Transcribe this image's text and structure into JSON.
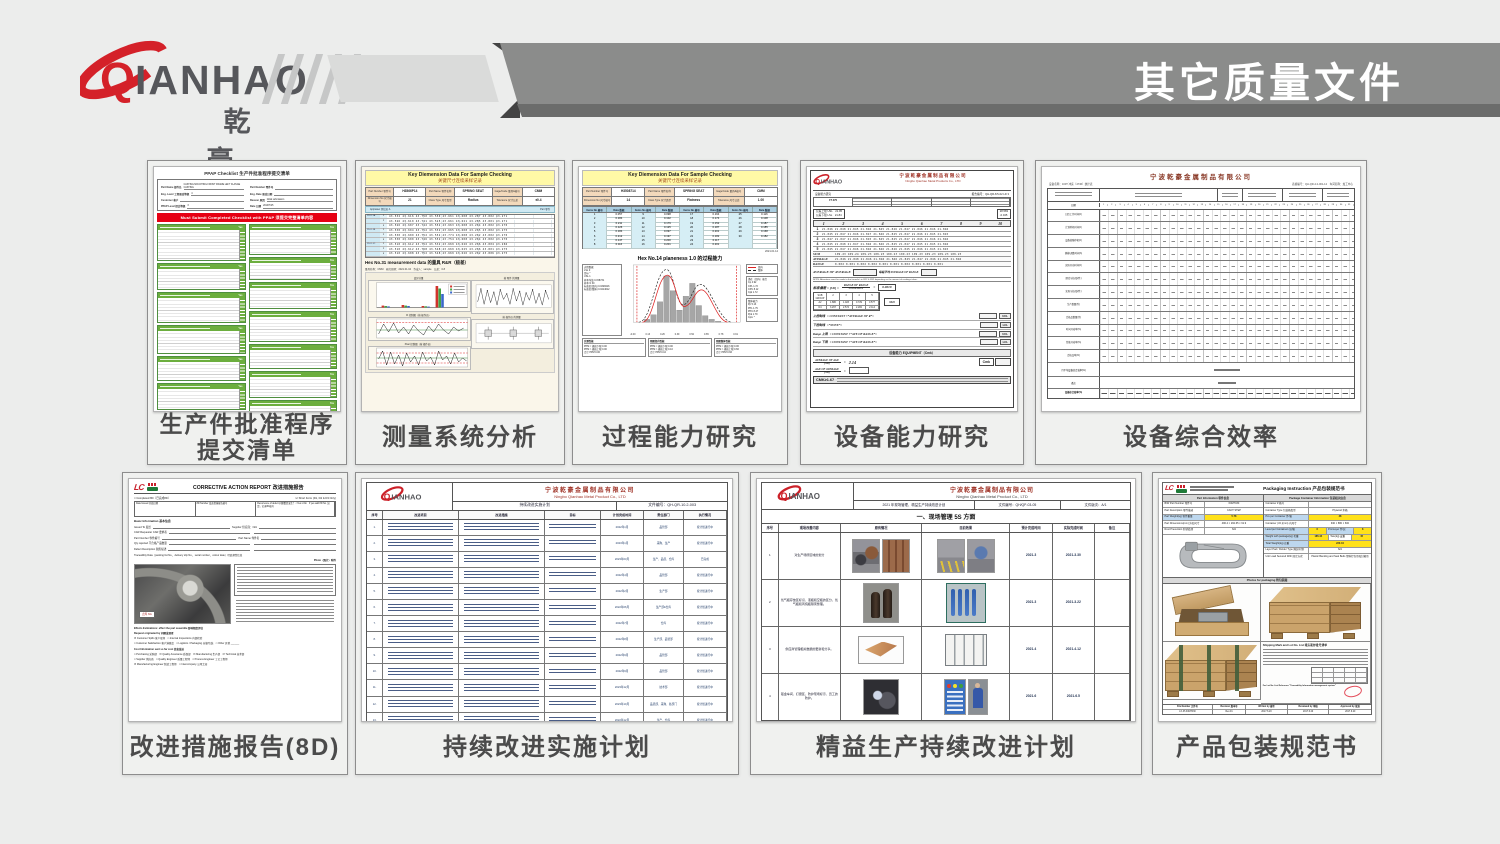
{
  "header": {
    "brand": "QIANHAO",
    "brand_cn": "乾 豪",
    "page_title": "其它质量文件"
  },
  "ppap": {
    "caption1": "生产件批准程序",
    "caption2": "提交清单",
    "title": "PPAP Checklist 生产件批准程序提交清单",
    "fields": [
      {
        "l": "Part Name 部件名",
        "v": "CASTING MOUNTING FRONT FRAME LEFT FLANGE CASTING"
      },
      {
        "l": "Part Number 零件号",
        "v": ""
      },
      {
        "l": "Eng. Level 工程更改等级",
        "v": "4"
      },
      {
        "l": "Eng. Date 更改日期",
        "v": ""
      },
      {
        "l": "Customer 客户",
        "v": ""
      },
      {
        "l": "Reason 原因",
        "v": "Initial submission"
      },
      {
        "l": "PPAP Level 提交等级",
        "v": "3"
      },
      {
        "l": "Date 日期",
        "v": "2019/7/25"
      }
    ],
    "banner": "Must Submit Completed Checklist with PPAP 须提交完整清单内容",
    "yes": "Yes",
    "sections_left": [
      {
        "h": 30
      },
      {
        "h": 20
      },
      {
        "h": 24
      },
      {
        "h": 22
      },
      {
        "h": 18
      },
      {
        "h": 20
      },
      {
        "h": 10
      }
    ],
    "sections_right": [
      {
        "h": 24
      },
      {
        "h": 16
      },
      {
        "h": 20
      },
      {
        "h": 24
      },
      {
        "h": 18
      },
      {
        "h": 20
      },
      {
        "h": 14
      }
    ]
  },
  "msa": {
    "caption": "测量系统分析",
    "title1": "Key Diemension Data For Sample Checking",
    "title2": "关键尺寸连续采样记录",
    "hdr": [
      {
        "l": "Part Number 零件号",
        "v": "H3566P14"
      },
      {
        "l": "Part Name 零件名称",
        "v": "SPRING SEAT"
      },
      {
        "l": "Gage/Code 量具&编号",
        "v": "CMM"
      },
      {
        "l": "Dimension No 尺寸编号",
        "v": "21"
      },
      {
        "l": "Class Type 尺寸类型",
        "v": "Radius"
      },
      {
        "l": "Tolerance 尺寸公差",
        "v": "±0.4"
      }
    ],
    "appraiser": "Appraiser 测试员 A",
    "part": "Part 零件",
    "grid": [
      {
        "g": "2101-1A",
        "s": "1",
        "v": "43.532 43.616 43.750 43.550 43.661 43.608 43.287 43.802 43.271"
      },
      {
        "g": "",
        "s": "2",
        "v": "43.526 43.610 43.741 43.525 43.661 43.621 43.285 43.801 43.271"
      },
      {
        "g": "",
        "s": "3",
        "v": "43.526 43.607 43.742 43.552 43.663 43.608 43.264 43.802 43.270"
      },
      {
        "g": "2101-1B",
        "s": "1",
        "v": "43.530 43.604 43.752 43.552 43.665 43.608 43.265 43.802 43.275"
      },
      {
        "g": "",
        "s": "2",
        "v": "43.530 43.609 43.752 43.552 43.774 43.608 43.262 43.802 43.270"
      },
      {
        "g": "",
        "s": "3",
        "v": "43.530 43.600 43.746 43.552 43.754 43.608 43.264 43.802 43.270"
      },
      {
        "g": "2101-1C",
        "s": "1",
        "v": "43.510 43.612 43.752 43.532 43.669 43.626 43.266 43.804 43.266"
      },
      {
        "g": "",
        "s": "2",
        "v": "43.510 43.612 43.768 43.548 43.669 43.625 43.266 43.801 43.275"
      },
      {
        "g": "",
        "s": "3",
        "v": "43.510 43.608 43.752 43.548 43.669 43.626 43.262 43.806 43.275"
      }
    ],
    "rr_title": "Hex No.31 measurement data 的量具 R&R（极差）",
    "meta": "量具名称：CMM　研究日期：2021.01.04　作成人：sample　公差：0.8",
    "c1": "变异分量",
    "c2": "R 控制图（按 操作员）",
    "c3": "Xbar 控制图（按 操作员）",
    "c4": "按 零件 的测量",
    "c5": "按 操作员 的测量"
  },
  "cap": {
    "caption": "过程能力研究",
    "title1": "Key Diemension Data For Sample Checking",
    "title2": "关键尺寸连续采样记录",
    "hdr": [
      {
        "l": "Part Number 零件号",
        "v": "H3508714"
      },
      {
        "l": "Part Name 零件名称",
        "v": "SPRING SEAT"
      },
      {
        "l": "Gage/Code 量具&编号",
        "v": "CMM"
      },
      {
        "l": "Dimension No 尺寸编号",
        "v": "14"
      },
      {
        "l": "Class Type 尺寸类型",
        "v": "Flatness"
      },
      {
        "l": "Tolerance 尺寸公差",
        "v": "1.00"
      }
    ],
    "thead": [
      "Items No 编号",
      "Data 数据",
      "Items No 编号",
      "Data 数据",
      "Items No 编号",
      "Data 数据",
      "Items No 编号",
      "Data 数据"
    ],
    "rows": [
      [
        "1",
        "0.057",
        "9",
        "0.098",
        "17",
        "0.164",
        "25",
        "0.116"
      ],
      [
        "2",
        "0.184",
        "10",
        "0.102",
        "18",
        "0.174",
        "26",
        "0.108"
      ],
      [
        "3",
        "0.211",
        "11",
        "0.179",
        "19",
        "0.152",
        "27",
        "0.187"
      ],
      [
        "4",
        "0.126",
        "12",
        "0.125",
        "20",
        "0.187",
        "28",
        "0.185"
      ],
      [
        "5",
        "0.184",
        "13",
        "0.097",
        "21",
        "0.201",
        "29",
        "0.168"
      ],
      [
        "6",
        "0.212",
        "14",
        "0.197",
        "22",
        "0.182",
        "30",
        "0.182"
      ],
      [
        "7",
        "0.147",
        "15",
        "0.200",
        "23",
        "0.117",
        "",
        ""
      ],
      [
        "8",
        "0.116",
        "16",
        "0.201",
        "24",
        "0.201",
        "",
        ""
      ]
    ],
    "date": "2021.01.14",
    "cap_title": "Hex No.14 planeness 1.0 的过程能力",
    "stats_left": [
      "过程数据",
      "LSL 0",
      "目标 *",
      "USL 1",
      "样本均值 0.158731",
      "样本 N 30",
      "标准差(组内) 0.0328416",
      "标准差(整体) 0.0414612"
    ],
    "legend1": "组内",
    "legend2": "整体",
    "stats_r1": [
      "潜在（组内）能力",
      "Cp 4.92",
      "CPL 1.72",
      "CPU 8.12",
      "Cpk 1.72"
    ],
    "stats_r2": [
      "整体能力",
      "Pp 5.13",
      "PPL 1.79",
      "PPU 8.47",
      "Ppk 1.79",
      "Cpm *"
    ],
    "xticks": [
      "-0.00",
      "0.13",
      "0.26",
      "0.39",
      "0.52",
      "0.65",
      "0.78",
      "0.91"
    ],
    "perf": [
      [
        "实测性能",
        "PPM < 规格下限 0.00",
        "PPM > 规格上限 0.00",
        "合计 PPM 0.00"
      ],
      [
        "预期组内性能",
        "PPM < 规格下限 0.00",
        "PPM > 规格上限 0.10",
        "合计 PPM 0.10"
      ],
      [
        "预期整体性能",
        "PPM < 规格下限 0.06",
        "PPM > 规格上限 0.66",
        "合计 PPM 0.66"
      ]
    ]
  },
  "equip": {
    "caption": "设备能力研究",
    "company_cn": "宁波乾豪金属制品有限公司",
    "company_en": "Ningbo Qianhao Metal Products Co., LTD",
    "subject": "设备能力研究",
    "report_no": "报告编号：QH-QR-8.5-02 LD 3",
    "machine": "FT-070",
    "usl": "公差上限 USL　21.95",
    "lsl": "公差下限 LSL　21.84",
    "box_r1": "28.583",
    "box_r2": "-0.045",
    "cols": [
      "1",
      "2",
      "3",
      "4",
      "5",
      "6",
      "7",
      "8",
      "9",
      "10"
    ],
    "rows": [
      {
        "n": "1",
        "v": "21.846 21.848 21.845 21.846 21.845 21.846 21.847 21.846 21.846 21.846"
      },
      {
        "n": "2",
        "v": "21.845 21.847 21.846 21.847 21.846 21.845 21.847 21.846 21.845 21.845"
      },
      {
        "n": "3",
        "v": "21.847 21.847 21.846 21.845 21.845 21.845 21.847 21.846 21.846 21.846"
      },
      {
        "n": "4",
        "v": "21.845 21.848 21.847 21.846 21.846 21.845 21.847 21.845 21.845 21.846"
      },
      {
        "n": "5",
        "v": "21.845 21.847 21.846 21.846 21.846 21.846 21.845 21.846 21.845 21.845"
      }
    ],
    "sum_label": "SUM",
    "sum": "109.23 109.24 109.23 109.23 109.23 109.23 109.23 109.23 109.23 109.23",
    "avg_label": "AVERAGE",
    "avg": "21.846 21.848 21.846 21.846 21.846 21.845 21.847 21.846 21.845 21.846",
    "rng_label": "RANGE",
    "rng": "0.002  0.001  0.002  0.002  0.001  0.001  0.002  0.001  0.001  0.001",
    "aoa": "AVERAGE OF AVERAGE",
    "aor": "每组平均 AVERAGE OF RANGE",
    "note": "NOTE: Alterations must be made to the formula's in R22 & R32 depending on the amount of readings taken.",
    "sd_lhs": "标准偏差 = [SD] =",
    "sd_top": "RANGE OF RANGE",
    "sd_bot": "CONSTANT",
    "sd_eq": "=",
    "sd_val": "0.0019",
    "const_head": [
      "SUB GROUP",
      "2",
      "3",
      "4",
      "5"
    ],
    "const_r1": [
      "A2",
      "1.880",
      "1.023",
      "0.729",
      "0.577"
    ],
    "const_r2": [
      "D4",
      "3.267",
      "2.574",
      "2.282",
      "2.114"
    ],
    "jsd": "3SD",
    "ctrl": [
      {
        "l": "上控制线",
        "f": "= CONSTANT ×“AVERAGE OF R”=",
        "b": "UCL"
      },
      {
        "l": "下控制线",
        "f": "=“NONE”=",
        "b": "LCL"
      },
      {
        "l": "Range 上限",
        "f": "= CONSTANT ×“AVE OF RANGE”=",
        "b": "UCL"
      },
      {
        "l": "Range 下限",
        "f": "= CONSTANT ×“AVE OF RANGE”=",
        "b": "LCL"
      }
    ],
    "equip_title": "设备能力 EQUIPMENT（Cmk）",
    "cmk1_top": "AVERAGE OF AGE",
    "cmk1_bot": "[SD]",
    "cmk1_val": "2.14",
    "cmk2_top": "AGE OF AVERAGE",
    "cmk2_bot": "[SD]",
    "cmk_box": "Cmk",
    "foot": "CMK≥1.67"
  },
  "oee": {
    "caption": "设备综合效率",
    "title": "宁波乾豪金属制品有限公司",
    "sub_left": "设备名称：160T 冲床（4736）统计表",
    "sub_right": "表格编号：QH-QR-4.2-001-12　车间名称：加工中心",
    "date_label": "日期",
    "days": [
      "1",
      "2",
      "3",
      "4",
      "5",
      "6",
      "7",
      "8",
      "9",
      "10",
      "11",
      "12",
      "13",
      "14",
      "15",
      "16",
      "17",
      "18",
      "19",
      "20",
      "21",
      "22",
      "23",
      "24",
      "25",
      "26",
      "27",
      "28",
      "29",
      "30",
      "31"
    ],
    "row_labels": [
      "日历工作时间(h)",
      "计划停机时间(h)",
      "设备故障停机(h)",
      "换模/调整时间(h)",
      "实际开动时间(h)",
      "理论节拍(秒/件)",
      "实际节拍(秒/件)",
      "生产数量(件)",
      "合格品数量(件)",
      "时间开动率(%)",
      "性能开动率(%)",
      "合格品率(%)"
    ],
    "merged1": "月平均设备综合效率(%)",
    "merged2": "备注",
    "oee_label": "设备综合效率(%)"
  },
  "r8d": {
    "caption": "改进措施报告(8D)",
    "logo": "LC",
    "title": "CORRECTIVE ACTION REPORT 改进措施报告",
    "sub_left": "□ Completed 8D（已完成8D）",
    "sub_right": "☑ Short Form (D1, D2 & D3 Only)",
    "hdr": [
      "Date Issued 开始日期",
      "8D Number 改进措施报告编号",
      "Recurrence of defect 问题重复发生？ □Yes ☑No　If yes add 8D No. 如是，记录8D编号"
    ],
    "basic_title": "Basic Information 基本信息",
    "basic": [
      {
        "a": "Issued To 发给",
        "b": "Supplier 供应商：N/A"
      },
      {
        "a": "CAR Requester CAR 要求者",
        "b": ""
      },
      {
        "a": "Part Number 零件编号",
        "b": "Part Name 零件名"
      },
      {
        "a": "Qty rejected 不合格产品数量",
        "b": ""
      },
      {
        "a": "Defect Description 缺陷描述",
        "b": ""
      }
    ],
    "trace": "Traceability Data（packing list No.、delivery slip No.、serial number、colour date）可追溯性信息",
    "photo_note": "Photo（照片）附件",
    "photo_label": "点焊 NG",
    "effects": "Effects Estimations: effect the part assemble 影响程度评估",
    "req_title": "Request originated by 问题发现者",
    "checks1a": "☑ Customer Spills 客户现场　□ Internal Inspections 内部检验",
    "checks1b": "□ Customer Satisfaction 客户满意度　□ Logistics / Packaging 仓储/包装　□ Other 其他 ______",
    "cost_title": "Cost Information sent so far cost 信息发送",
    "cost1": "□ Purchasing 采购部　☑ Quality Assurance 质保部　☑ Manufacturing 生产部　☑ Technical 技术部",
    "cost2": "□ Supplier 供应商　□ Quality Engineer 质量工程师　□ Process Engineer 工艺工程师",
    "cost3": "☑ Manufacturing Engineer 制造工程师　□ Intercompany 公司之间"
  },
  "ci": {
    "caption": "持续改进实施计划",
    "company_cn": "宁波乾豪金属制品有限公司",
    "company_en": "Ningbo Qianhao Metal Product Co., LTD",
    "plan_title": "持续改进实施计划",
    "doc_no": "文件编号：QH-QR-10.2-003",
    "cols": [
      "序号",
      "改进项目",
      "改进措施",
      "目标",
      "计划完成时间",
      "责任部门",
      "执行情况"
    ],
    "rows": [
      {
        "n": "1.",
        "date": "2022年1月",
        "dept": "品管部",
        "status": "按计划进行中"
      },
      {
        "n": "2.",
        "date": "2023年1月",
        "dept": "采购、生产",
        "status": "按计划进行中"
      },
      {
        "n": "3.",
        "date": "2023年03月",
        "dept": "生产、品质、仓库",
        "status": "已完成"
      },
      {
        "n": "4.",
        "date": "2022年4月",
        "dept": "品管部",
        "status": "按计划进行中"
      },
      {
        "n": "5.",
        "date": "2022年2月",
        "dept": "生产部",
        "status": "按计划进行中"
      },
      {
        "n": "6.",
        "date": "2022年06月",
        "dept": "生产部&仓库",
        "status": "按计划进行中"
      },
      {
        "n": "7.",
        "date": "2022年7月",
        "dept": "仓库",
        "status": "按计划进行中"
      },
      {
        "n": "8.",
        "date": "2022年8月",
        "dept": "生产部、品管部",
        "status": "按计划进行中"
      },
      {
        "n": "9.",
        "date": "2022年9月",
        "dept": "品管部",
        "status": "按计划进行中"
      },
      {
        "n": "10.",
        "date": "2022年9月",
        "dept": "品管部",
        "status": "按计划进行中"
      },
      {
        "n": "11.",
        "date": "2023年12月",
        "dept": "技术部",
        "status": "按计划进行中"
      },
      {
        "n": "12.",
        "date": "2023年10月",
        "dept": "品质部、采购、各部门",
        "status": "按计划进行中"
      },
      {
        "n": "13.",
        "date": "2022年12月",
        "dept": "生产、仓库",
        "status": "按计划进行中"
      }
    ]
  },
  "lean": {
    "caption": "精益生产持续改进计划",
    "company_cn": "宁波乾豪金属制品有限公司",
    "company_en": "Ningbo Qianhao Metal Product Co., LTD",
    "title2": "2021 年现场管理、精益生产持续改进计划",
    "doc_no": "文件编号：QH/QP-03-05",
    "rev": "文件版次：A/1",
    "section": "一、现场管理 5S 方面",
    "cols": [
      "序号",
      "现场改善内容",
      "原有情况",
      "目前效果",
      "预计完成时间",
      "实际完成时间",
      "备注"
    ],
    "rows": [
      {
        "n": "1",
        "desc": "对生产场所区域的划分",
        "plan": "2021.3",
        "actual": "2021.3.30"
      },
      {
        "n": "2",
        "desc": "氧气瓶存放区标识、液瓶和空瓶的区分，氧气瓶和丙烷瓶隔离整理。",
        "plan": "2021.3",
        "actual": "2021.3.22"
      },
      {
        "n": "3",
        "desc": "供应商管理相关数据的更新和分享。",
        "plan": "2021.4",
        "actual": "2021.4.12"
      },
      {
        "n": "4",
        "desc": "钣金车间、打磨区、防护现场标示、员工的防护。",
        "plan": "2021.6",
        "actual": "2021.6.5"
      }
    ]
  },
  "pkg": {
    "caption": "产品包装规范书",
    "logo": "LC",
    "title": "Packaging Instruction 产品包装规范书",
    "sec1": "Part Information 零件信息",
    "sec2": "Package Container Information 包装相关信息",
    "l1": "BIW Part Number 零件号",
    "v1": "K0M7030",
    "l2": "Part Description 零件描述",
    "v2": "CANT STEP",
    "l3": "Part Weight(kg) 零件重量",
    "v3": "5.78",
    "l4": "Part Dimensions(mm) 外形尺寸",
    "v4": "496.4 × 292.65 × 61.9",
    "l5": "Rust Prevention 防锈处理",
    "v5": "N/A",
    "r1": "Container # 箱号",
    "rv1": "",
    "r2": "Container Type 包装箱类型",
    "rv2": "Plywood 木箱",
    "r3": "Pcs per Container 件/箱",
    "rv3": "48",
    "r4": "Container (I.D.)(mm) 内尺寸",
    "rv4": "940 × 880 × 600",
    "r5": "Level per Containers 层/箱",
    "rv5": "6",
    "r5b": "Pcs/Layer 件/层",
    "rv5b": "8",
    "r6": "Weight with package(kg) 毛重",
    "rv6": "185.44",
    "r6b": "Tare(kg) 皮重",
    "rv6b": "45",
    "r7": "Total Weight(kg) 总重",
    "rv7": "220.44",
    "r8": "Layer Pad / Divider Type 隔层/衬垫",
    "rv8": "N/A",
    "r9": "Unit Load Secured With 固定方式",
    "rv9": "Plastic Banding and Seal Belts 塑料打包带和封箱带",
    "photos_title": "Photos for packaging 附包装图",
    "ship_title": "Shipping Mark and Lot No. List 唛头和炉批号清单",
    "ship_note": "For Lot No. List Reference \"Traceability Information management system\"",
    "foot": [
      "File Number 文件号",
      "Revision 版本号",
      "Written by 编写",
      "Reviewed by 审核",
      "Approved by 批准"
    ],
    "footv": [
      "LX-PI-K0M7030",
      "Rev.01",
      "2017.6.20",
      "2017.6.20",
      "2017.6.20"
    ]
  }
}
